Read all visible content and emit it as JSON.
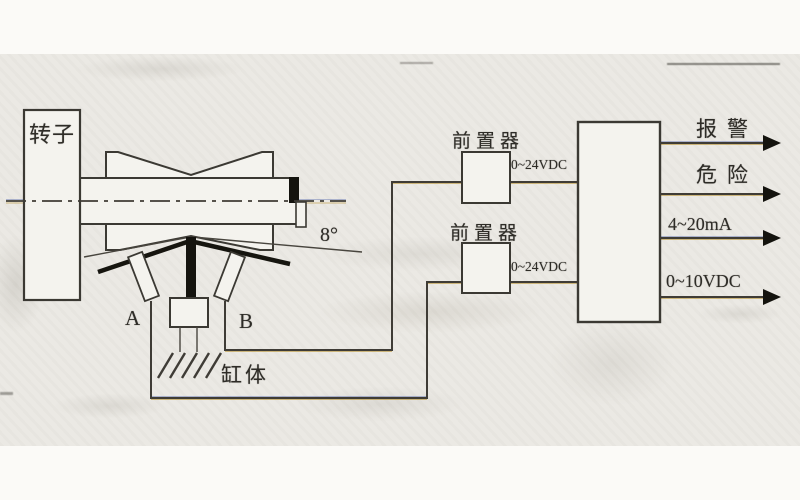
{
  "figure": {
    "rotor_label": "转子",
    "probe_a_label": "A",
    "probe_b_label": "B",
    "cylinder_label": "缸体",
    "angle_label": "8°",
    "preamps": [
      {
        "label": "前置器",
        "supply": "0~24VDC"
      },
      {
        "label": "前置器",
        "supply": "0~24VDC"
      }
    ],
    "outputs": [
      {
        "label": "报警"
      },
      {
        "label": "危险"
      },
      {
        "label": "4~20mA"
      },
      {
        "label": "0~10VDC"
      }
    ]
  },
  "colors": {
    "ink": "#3b3933",
    "probe_ink": "#14130e",
    "paper": "#ebe9e4",
    "fringe_warm": "#b28a22",
    "fringe_cool": "#4c60a8"
  }
}
